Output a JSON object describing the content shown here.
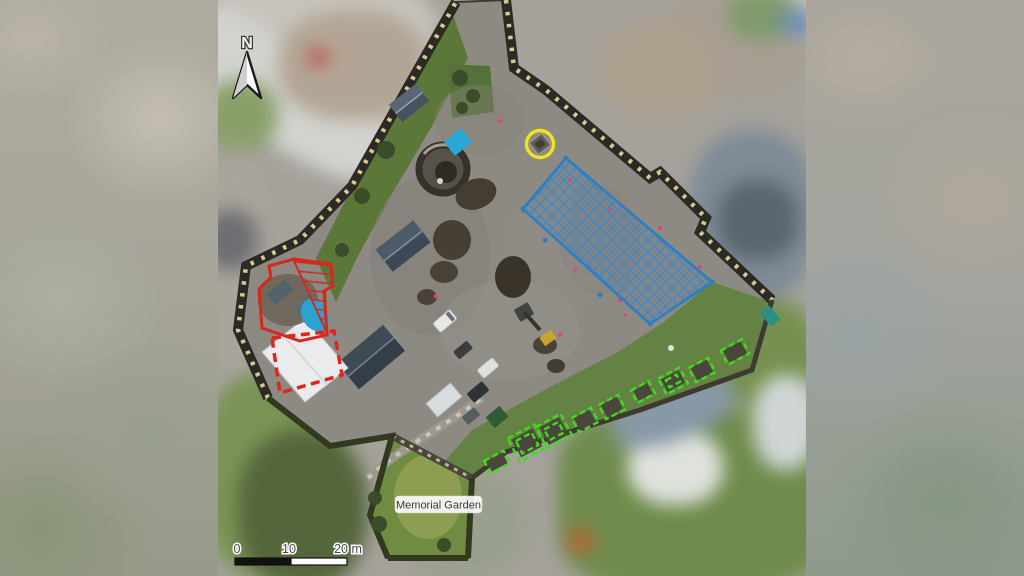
{
  "figure": {
    "type": "aerial-orthophoto-site-plan",
    "north_label": "N",
    "place_label": "Memorial Garden",
    "scale_bar": {
      "ticks": [
        "0",
        "10",
        "20 m"
      ],
      "bar_colors": [
        "#111111",
        "#ffffff"
      ]
    },
    "annotation_colors": {
      "excavation_outline_red": "#d5281e",
      "dashed_outline_red": "#e0261c",
      "survey_hatch_blue": "#2e7fc2",
      "plot_outline_green": "#3fdc1a",
      "highlight_circle_yellow": "#f1e320",
      "tarp_blue": "#2ba7d6"
    }
  }
}
